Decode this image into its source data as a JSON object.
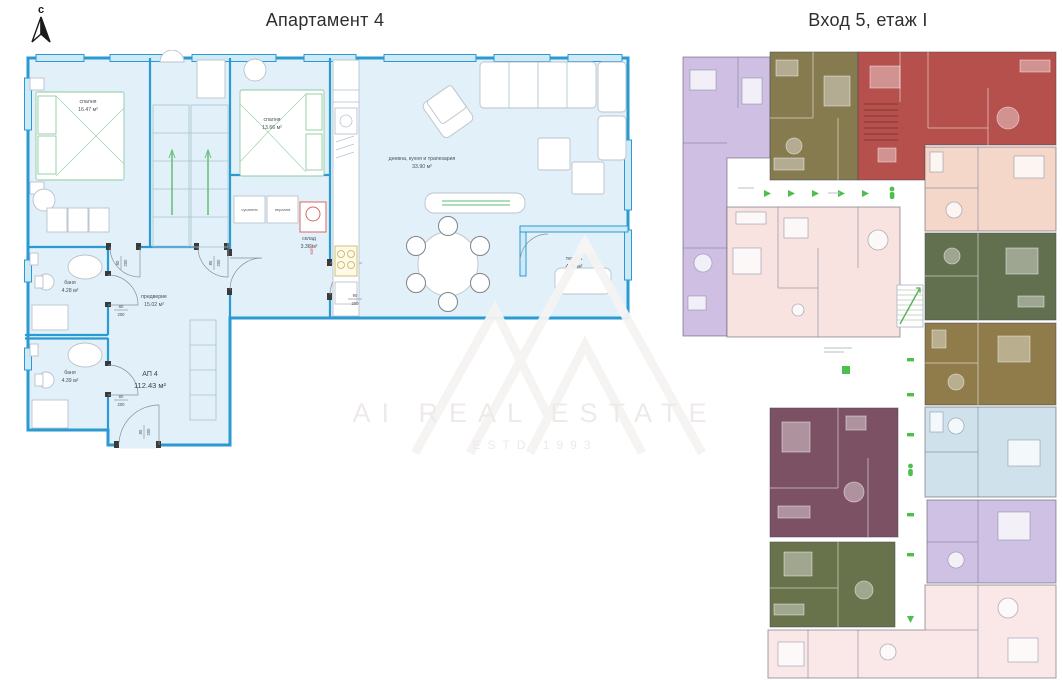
{
  "page": {
    "background": "#ffffff"
  },
  "compass": {
    "label": "с"
  },
  "left_plan": {
    "title": "Апартамент 4",
    "apartment": {
      "name": "АП 4",
      "area": "112.43 м²"
    },
    "colors": {
      "wall": "#2a9ad2",
      "floor": "#e2f0f9",
      "window": "#cfe9f7"
    },
    "rooms": [
      {
        "name": "спалня",
        "area": "16.47 м²"
      },
      {
        "name": "спалня",
        "area": "13.66 м²"
      },
      {
        "name": "дневна, кухня и трапезария",
        "area": "33.90 м²"
      },
      {
        "name": "склад",
        "area": "3.36 м²"
      },
      {
        "name": "баня",
        "area": "4.28 м²"
      },
      {
        "name": "баня",
        "area": "4.39 м²"
      },
      {
        "name": "предверие",
        "area": "15.02 м²"
      },
      {
        "name": "тераса",
        "area": "4.38 м²"
      }
    ],
    "appliances": [
      {
        "label": "сушилня"
      },
      {
        "label": "пералня"
      },
      {
        "label": "котел"
      }
    ],
    "door_dimensions": [
      {
        "w": "80",
        "h": "200"
      },
      {
        "w": "80",
        "h": "200"
      },
      {
        "w": "80",
        "h": "200"
      },
      {
        "w": "80",
        "h": "200"
      },
      {
        "w": "80",
        "h": "200"
      },
      {
        "w": "90",
        "h": "200"
      }
    ]
  },
  "right_plan": {
    "title": "Вход 5, етаж I",
    "marker_color": "#4cbf4c",
    "units": [
      {
        "id": "unit-top-left",
        "color": "#cfbfe2"
      },
      {
        "id": "unit-top-mid",
        "color": "#867a4f"
      },
      {
        "id": "unit-top-right",
        "color": "#b5504d"
      },
      {
        "id": "unit-right-1",
        "color": "#f5d7c9"
      },
      {
        "id": "unit-right-2",
        "color": "#63704f"
      },
      {
        "id": "unit-right-3",
        "color": "#8f7c4a"
      },
      {
        "id": "unit-right-4",
        "color": "#cfe1ea"
      },
      {
        "id": "unit-right-5",
        "color": "#cfc1e3"
      },
      {
        "id": "unit-bottom",
        "color": "#fae8e8"
      },
      {
        "id": "unit-mid-left",
        "color": "#7c5164"
      },
      {
        "id": "unit-mid-left-2",
        "color": "#68724b"
      },
      {
        "id": "unit-center",
        "color": "#f8e3e1"
      }
    ]
  },
  "watermark": {
    "brand": "AI REAL ESTATE",
    "estd": "ESTD 1993"
  }
}
